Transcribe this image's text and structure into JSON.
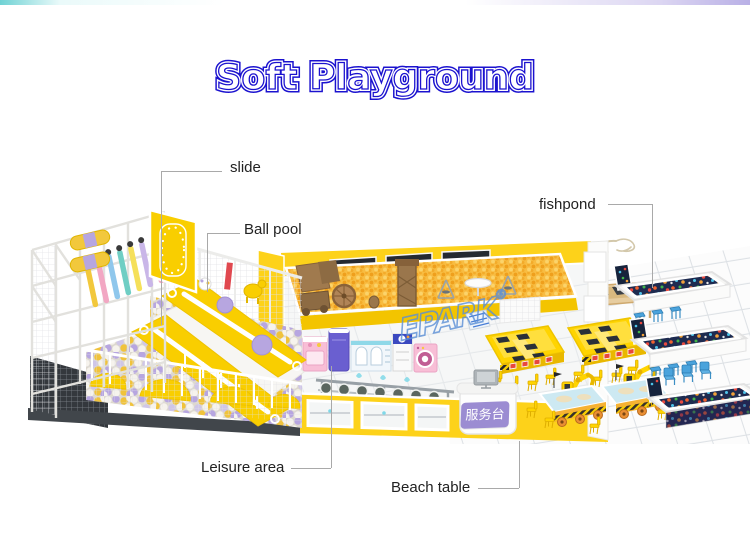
{
  "header": {
    "title": "Soft Playground"
  },
  "callouts": {
    "slide": "slide",
    "ball_pool": "Ball pool",
    "fishpond": "fishpond",
    "leisure_area": "Leisure area",
    "beach_table": "Beach table"
  },
  "watermark": {
    "brand": "EPARK",
    "registered": "®"
  },
  "service_desk": {
    "sign": "服务台"
  },
  "colors": {
    "title_blue": "#1b12cf",
    "label_text": "#222222",
    "leader_line": "#a9a9a9",
    "playground_yellow": "#f9ce00",
    "ball_lavender": "#b7a6e0",
    "sand_orange": "#f5a623",
    "sign_purple": "#9b8cd2",
    "stool_blue": "#4aa3dc",
    "watermark_blue": "#5b8fd6"
  }
}
